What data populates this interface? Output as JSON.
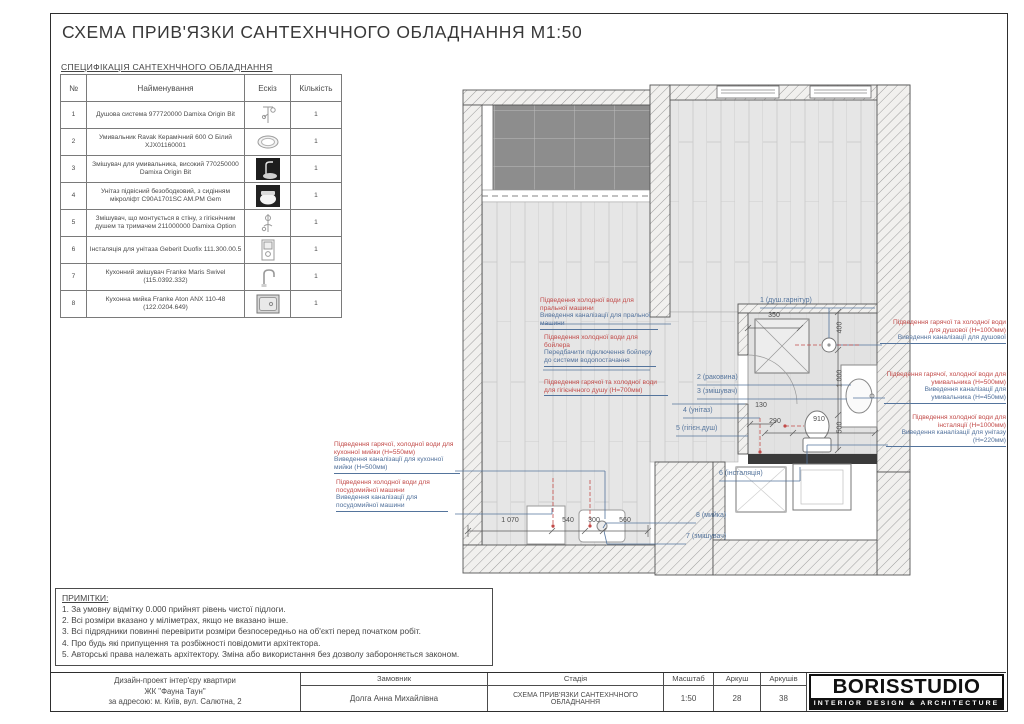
{
  "sheet": {
    "title": "СХЕМА ПРИВ'ЯЗКИ САНТЕХНЧНОГО ОБЛАДНАННЯ М1:50",
    "spec_title": "СПЕЦИФІКАЦІЯ САНТЕХНЧНОГО ОБЛАДНАННЯ"
  },
  "spec_table": {
    "headers": {
      "num": "№",
      "name": "Найменування",
      "sketch": "Ескіз",
      "qty": "Кількість"
    },
    "rows": [
      {
        "num": "1",
        "name": "Душова система 977720000 Damixa Origin Bit",
        "sketch": "shower-system",
        "qty": "1"
      },
      {
        "num": "2",
        "name": "Умивальник Ravak Керамічний 600 О Білий XJX01160001",
        "sketch": "washbasin",
        "qty": "1"
      },
      {
        "num": "3",
        "name": "Змішувач для умивальника, високий 770250000 Damixa Origin Bit",
        "sketch": "tall-basin-mixer",
        "qty": "1"
      },
      {
        "num": "4",
        "name": "Унітаз підвісний безободковий, з сидінням мікроліфт C90A1701SC AM.PM Gem",
        "sketch": "wall-hung-toilet",
        "qty": "1"
      },
      {
        "num": "5",
        "name": "Змішувач, що монтується в стіну, з гігієнічним душем та тримачем 211000000 Damixa Option",
        "sketch": "hygienic-shower-mixer",
        "qty": "1"
      },
      {
        "num": "6",
        "name": "Інсталяція для унітаза Geberit Duofix 111.300.00.5",
        "sketch": "toilet-installation-frame",
        "qty": "1"
      },
      {
        "num": "7",
        "name": "Кухонний змішувач Franke Maris Swivel (115.0392.332)",
        "sketch": "kitchen-mixer",
        "qty": "1"
      },
      {
        "num": "8",
        "name": "Кухонна мийка Franke Aton ANX 110-48 (122.0204.649)",
        "sketch": "kitchen-sink",
        "qty": "1"
      }
    ]
  },
  "plan": {
    "fixture_labels": {
      "shower_set": "1 (душ.гарнітур)",
      "basin": "2 (раковина)",
      "basin_mixer": "3 (змішувач)",
      "toilet": "4 (унітаз)",
      "hygienic_shower": "5 (гігієн.душ)",
      "installation": "6 (інсталяція)",
      "kitchen_mixer": "7 (змішувач)",
      "kitchen_sink": "8 (мийка)"
    },
    "dimensions": {
      "shower_width": "350",
      "v_400": "400",
      "v_1000": "1 000",
      "v_500": "500",
      "d_130": "130",
      "d_290": "290",
      "d_910": "910",
      "b_1070": "1 070",
      "b_540": "540",
      "b_300": "300",
      "b_560": "560"
    },
    "annotations": {
      "kitchen_sink_supply": {
        "red": "Підведення гарячої, холодної води для кухонної мийки (Н=550мм)",
        "blue": "Виведення каналізації для кухонної мийки (Н=500мм)"
      },
      "dishwasher": {
        "red": "Підведення холодної води для посудомийної машини",
        "blue": "Виведення каналізації для посудомийної машини"
      },
      "washing_machine": {
        "red": "Підведення холодної води для пральної машини",
        "blue": "Виведення каналізації для пральної машини"
      },
      "boiler": {
        "red": "Підведення холодної води для бойлера",
        "blue": "Передбачити підключення бойлеру до системи водопостачання"
      },
      "hygienic_shower": {
        "red": "Підведення гарячої та холодної води для гігієнічного душу (Н=700мм)"
      },
      "shower": {
        "red": "Підведення гарячої та холодної води для душової (Н=1000мм)",
        "blue": "Виведення каналізації для душової"
      },
      "washbasin": {
        "red": "Підведення гарячої, холодної води для умивальника (Н=500мм)",
        "blue": "Виведення каналізації для умивальника (Н=450мм)"
      },
      "installation": {
        "red": "Підведення холодної води для інсталяції (Н=1000мм)",
        "blue": "Виведення каналізації для унітазу (Н=220мм)"
      }
    }
  },
  "notes": {
    "heading": "ПРИМІТКИ:",
    "items": [
      "1. За умовну відмітку 0.000 прийнят рівень чистої підлоги.",
      "2. Всі розміри вказано у міліметрах, якщо не вказано інше.",
      "3. Всі підрядники повинні перевірити розміри безпосередньо на об'єкті перед початком робіт.",
      "4. Про будь які припущення та розбіжності повідомити архітектора.",
      "5. Авторські права належать архітектору. Зміна або використання без дозволу забороняється законом."
    ]
  },
  "titleblock": {
    "project_line1": "Дизайн-проект інтер'єру квартири",
    "project_line2": "ЖК \"Фауна Таун\"",
    "project_line3": "за адресою: м. Київ, вул. Салютна, 2",
    "customer_label": "Замовник",
    "customer": "Долга Анна Михайлівна",
    "stage_label": "Стадія",
    "stage": "СХЕМА ПРИВ'ЯЗКИ САНТЕХНЧНОГО ОБЛАДНАННЯ",
    "scale_label": "Масштаб",
    "scale": "1:50",
    "sheet_label": "Аркуш",
    "sheet": "28",
    "sheets_label": "Аркушів",
    "sheets": "38"
  },
  "logo": {
    "name": "BORISSTUDIO",
    "tagline": "INTERIOR DESIGN & ARCHITECTURE"
  },
  "colors": {
    "annotation_red": "#c24b49",
    "annotation_blue": "#54749c",
    "wall_outline": "#555555",
    "floor_fill": "#e6e6e6",
    "balcony_tile": "#8d8d8d",
    "logo_black": "#101010"
  }
}
